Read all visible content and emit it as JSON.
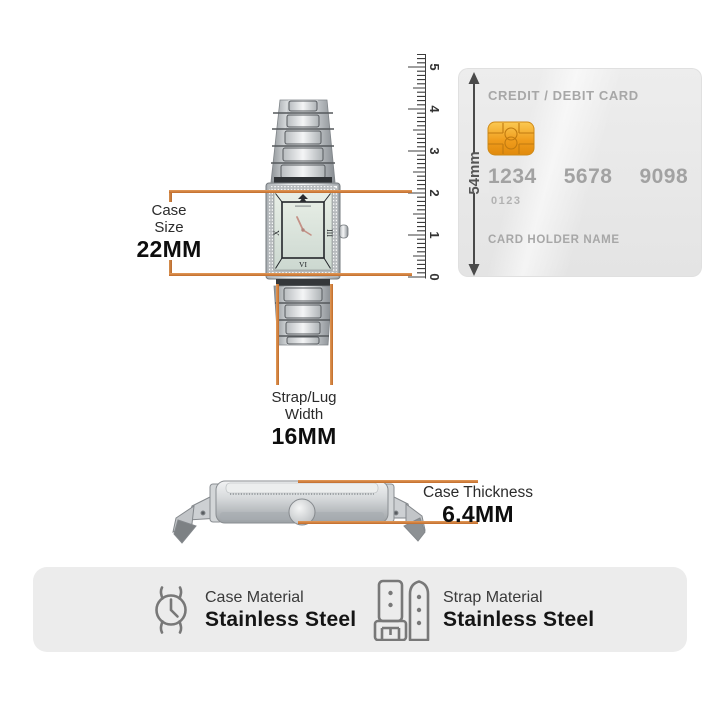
{
  "annotations": {
    "case_size": {
      "line1": "Case",
      "line2": "Size",
      "value": "22MM"
    },
    "strap_width": {
      "line1": "Strap/Lug",
      "line2": "Width",
      "value": "16MM"
    },
    "case_thickness": {
      "label": "Case Thickness",
      "value": "6.4MM"
    }
  },
  "ruler": {
    "tick_labels": [
      "0",
      "1",
      "2",
      "3",
      "4",
      "5"
    ]
  },
  "card": {
    "title": "CREDIT / DEBIT CARD",
    "number_groups": [
      "1234",
      "5678",
      "9098"
    ],
    "small_number": "0123",
    "holder_label": "CARD HOLDER NAME",
    "height_label": "54mm"
  },
  "watch": {
    "dial_numerals": {
      "left": "X",
      "right": "III",
      "bottom": "VI"
    }
  },
  "materials": {
    "items": [
      {
        "icon": "watch-case-icon",
        "label": "Case Material",
        "value": "Stainless Steel"
      },
      {
        "icon": "watch-strap-icon",
        "label": "Strap Material",
        "value": "Stainless Steel"
      }
    ]
  },
  "colors": {
    "accent": "#d6833e",
    "bracket": "#c67c3a",
    "chip_gold": "#f2a21d",
    "card_bg": "#e9e9e9",
    "band_bg": "#ececec"
  }
}
